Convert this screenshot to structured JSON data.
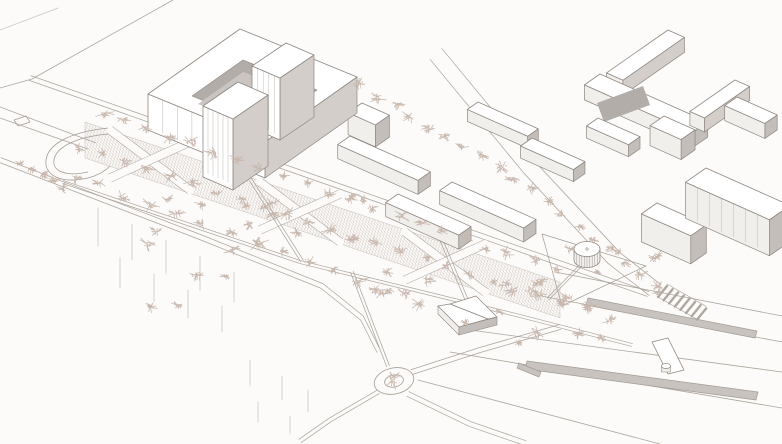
{
  "scene": {
    "width": 782,
    "height": 444,
    "background": "#fcfbf9",
    "colors": {
      "line": "#a49c94",
      "faint": "#c6c0ba",
      "bstroke": "#8f8780",
      "top": "#ffffff",
      "front": "#f1efec",
      "side": "#d3cec9",
      "sidedark": "#c3beb9",
      "court": "#b2ada8",
      "courtfloor": "#cac5c0",
      "tree": "#c8b7ad",
      "hatch": "#c2b4ab",
      "median": "#c8c3be",
      "stripe": "#aaa39c",
      "fline": "#b9b3ad"
    },
    "axes": {
      "a": [
        0.913,
        0.407
      ],
      "b": [
        -0.82,
        0.572
      ]
    }
  },
  "layers": [
    {
      "name": "street-topleft-cross",
      "type": "polyline",
      "pts": [
        [
          173,
          0
        ],
        [
          32,
          79
        ],
        [
          0,
          88
        ]
      ]
    },
    {
      "name": "street-topleft-corner",
      "type": "polyline",
      "pts": [
        [
          0,
          30
        ],
        [
          58,
          8
        ]
      ],
      "light": true
    },
    {
      "name": "street-left-a",
      "type": "polyline",
      "pts": [
        [
          0,
          107
        ],
        [
          96,
          143
        ]
      ]
    },
    {
      "name": "street-left-b",
      "type": "polyline",
      "pts": [
        [
          0,
          118
        ],
        [
          88,
          149
        ]
      ]
    },
    {
      "name": "car-left",
      "type": "polygon",
      "pts": [
        [
          14,
          120
        ],
        [
          26,
          116
        ],
        [
          30,
          122
        ],
        [
          18,
          126
        ]
      ],
      "fill": "none"
    },
    {
      "name": "road-park-north",
      "type": "double",
      "pts": [
        [
          30,
          78
        ],
        [
          350,
          190
        ],
        [
          648,
          294
        ]
      ],
      "gap": 5
    },
    {
      "name": "road-park-south",
      "type": "double",
      "pts": [
        [
          0,
          160
        ],
        [
          200,
          237
        ],
        [
          322,
          286
        ],
        [
          362,
          318
        ],
        [
          378,
          350
        ]
      ],
      "gap": 5
    },
    {
      "name": "road-diagonal-ne",
      "type": "double",
      "pts": [
        [
          436,
          54
        ],
        [
          530,
          168
        ],
        [
          614,
          258
        ],
        [
          655,
          290
        ]
      ],
      "gap": 16
    },
    {
      "name": "road-roundabout-ne",
      "type": "double",
      "pts": [
        [
          412,
          372
        ],
        [
          480,
          350
        ],
        [
          560,
          327
        ]
      ],
      "gap": 5
    },
    {
      "name": "road-roundabout-se",
      "type": "double",
      "pts": [
        [
          408,
          394
        ],
        [
          470,
          424
        ],
        [
          525,
          443
        ]
      ],
      "gap": 5
    },
    {
      "name": "road-roundabout-sw",
      "type": "double",
      "pts": [
        [
          378,
          392
        ],
        [
          330,
          420
        ],
        [
          300,
          441
        ]
      ],
      "gap": 4
    },
    {
      "name": "boulevard-edge-1",
      "type": "polyline",
      "pts": [
        [
          555,
          272
        ],
        [
          782,
          316
        ]
      ]
    },
    {
      "name": "boulevard-edge-2",
      "type": "polyline",
      "pts": [
        [
          536,
          295
        ],
        [
          782,
          342
        ]
      ]
    },
    {
      "name": "boulevard-edge-3",
      "type": "polyline",
      "pts": [
        [
          470,
          330
        ],
        [
          782,
          372
        ]
      ]
    },
    {
      "name": "boulevard-edge-4",
      "type": "polyline",
      "pts": [
        [
          450,
          352
        ],
        [
          782,
          408
        ]
      ]
    },
    {
      "name": "boulevard-edge-5",
      "type": "polyline",
      "pts": [
        [
          418,
          380
        ],
        [
          660,
          444
        ]
      ]
    },
    {
      "name": "plaza-hatch-band",
      "type": "hatchband",
      "pts": [
        [
          85,
          122
        ],
        [
          560,
          282
        ],
        [
          560,
          318
        ],
        [
          85,
          158
        ]
      ]
    },
    {
      "name": "park-path-x1a",
      "type": "whitestrip",
      "a": [
        110,
        130
      ],
      "b": [
        190,
        190
      ]
    },
    {
      "name": "park-path-x1b",
      "type": "whitestrip",
      "a": [
        190,
        142
      ],
      "b": [
        110,
        178
      ]
    },
    {
      "name": "park-path-x2a",
      "type": "whitestrip",
      "a": [
        260,
        182
      ],
      "b": [
        340,
        242
      ]
    },
    {
      "name": "park-path-x2b",
      "type": "whitestrip",
      "a": [
        340,
        194
      ],
      "b": [
        260,
        230
      ]
    },
    {
      "name": "park-path-x3a",
      "type": "whitestrip",
      "a": [
        405,
        232
      ],
      "b": [
        485,
        292
      ]
    },
    {
      "name": "park-path-x3b",
      "type": "whitestrip",
      "a": [
        485,
        244
      ],
      "b": [
        405,
        280
      ]
    },
    {
      "name": "median-strip-1",
      "type": "polygon",
      "pts": [
        [
          588,
          298
        ],
        [
          757,
          331
        ],
        [
          755,
          338
        ],
        [
          586,
          305
        ]
      ],
      "fill": "median",
      "stroke": true
    },
    {
      "name": "median-strip-2",
      "type": "polygon",
      "pts": [
        [
          527,
          361
        ],
        [
          758,
          392
        ],
        [
          756,
          400
        ],
        [
          525,
          369
        ]
      ],
      "fill": "median",
      "stroke": true
    },
    {
      "name": "median-strip-3",
      "type": "polygon",
      "pts": [
        [
          519,
          363
        ],
        [
          541,
          372
        ],
        [
          539,
          377
        ],
        [
          517,
          368
        ]
      ],
      "fill": "median",
      "stroke": true
    },
    {
      "name": "crosswalk",
      "type": "crosswalk",
      "start": [
        667,
        286
      ],
      "step": [
        5.6,
        3.2
      ],
      "n": 8,
      "vec": [
        -9,
        11
      ]
    },
    {
      "name": "pedestrian-bridge",
      "type": "bridge",
      "poly": [
        [
          652,
          342
        ],
        [
          668,
          338
        ],
        [
          684,
          370
        ],
        [
          668,
          374
        ]
      ],
      "cyl": [
        666,
        366
      ]
    },
    {
      "name": "park-path-mid",
      "type": "double",
      "pts": [
        [
          63,
          182
        ],
        [
          300,
          262
        ],
        [
          520,
          316
        ],
        [
          632,
          345
        ]
      ],
      "gap": 3
    },
    {
      "name": "park-path-d1",
      "type": "double",
      "pts": [
        [
          240,
          163
        ],
        [
          302,
          261
        ]
      ],
      "gap": 3
    },
    {
      "name": "park-path-d2",
      "type": "double",
      "pts": [
        [
          352,
          272
        ],
        [
          388,
          366
        ]
      ],
      "gap": 3
    },
    {
      "name": "park-path-d3",
      "type": "double",
      "pts": [
        [
          432,
          218
        ],
        [
          468,
          303
        ]
      ],
      "gap": 3
    },
    {
      "name": "park-loop-outer",
      "type": "pathd",
      "d": "M108,128 C70,132 48,144 46,160 C44,176 62,184 88,178 C100,175 106,170 110,166"
    },
    {
      "name": "park-loop-inner",
      "type": "pathd",
      "d": "M108,134 C76,137 56,147 54,160 C52,171 66,177 88,172"
    },
    {
      "name": "pavilion-plaza-outline",
      "type": "polygon",
      "pts": [
        [
          542,
          234
        ],
        [
          646,
          266
        ],
        [
          562,
          306
        ]
      ],
      "fill": "none"
    },
    {
      "name": "pavilion-path",
      "type": "double",
      "pts": [
        [
          584,
          262
        ],
        [
          548,
          299
        ]
      ],
      "gap": 2.5
    },
    {
      "name": "roundabout",
      "type": "roundabout",
      "cx": 394,
      "cy": 381,
      "rx": 20,
      "ry": 13,
      "irx": 9.5,
      "iry": 6,
      "rot": -12
    },
    {
      "name": "ground-ticks",
      "type": "ticks",
      "items": [
        [
          98,
          208,
          38
        ],
        [
          132,
          224,
          36
        ],
        [
          166,
          240,
          34
        ],
        [
          200,
          256,
          34
        ],
        [
          234,
          272,
          30
        ],
        [
          120,
          258,
          30
        ],
        [
          154,
          274,
          28
        ],
        [
          188,
          290,
          28
        ],
        [
          222,
          306,
          26
        ],
        [
          250,
          360,
          26
        ],
        [
          282,
          376,
          24
        ],
        [
          308,
          390,
          22
        ],
        [
          258,
          402,
          20
        ],
        [
          290,
          416,
          18
        ]
      ]
    },
    {
      "name": "bldg-cross-wing-a",
      "type": "bslab",
      "x": 668,
      "y": 30,
      "l": 75,
      "w": 18,
      "h": 15
    },
    {
      "name": "bldg-cross-bar",
      "type": "slab",
      "x": 600,
      "y": 74,
      "l": 118,
      "w": 19,
      "h": 15
    },
    {
      "name": "bldg-cross-wing-b",
      "type": "bslab",
      "x": 735,
      "y": 80,
      "l": 55,
      "w": 16,
      "h": 14
    },
    {
      "name": "bldg-cross-courtyard",
      "type": "polygon",
      "pts": [
        [
          597,
          103
        ],
        [
          643,
          86
        ],
        [
          650,
          105
        ],
        [
          604,
          122
        ]
      ],
      "fill": "court"
    },
    {
      "name": "bldg-bar-ne",
      "type": "slab",
      "x": 737,
      "y": 97,
      "l": 44,
      "w": 15,
      "h": 15
    },
    {
      "name": "bldg-bar-n1",
      "type": "slab",
      "x": 478,
      "y": 102,
      "l": 66,
      "w": 13,
      "h": 12
    },
    {
      "name": "bldg-bar-n2",
      "type": "slab",
      "x": 598,
      "y": 118,
      "l": 46,
      "w": 14,
      "h": 12
    },
    {
      "name": "bldg-bar-n3",
      "type": "slab",
      "x": 532,
      "y": 138,
      "l": 58,
      "w": 14,
      "h": 12
    },
    {
      "name": "bldg-cube-c1",
      "type": "slab",
      "x": 362,
      "y": 103,
      "l": 30,
      "w": 17,
      "h": 22
    },
    {
      "name": "bldg-courtyard-complex",
      "type": "courtyard",
      "outer": [
        [
          148,
          94
        ],
        [
          240,
          29
        ],
        [
          357,
          77
        ],
        [
          265,
          142
        ]
      ],
      "hole": [
        [
          192,
          96
        ],
        [
          243,
          60
        ],
        [
          317,
          90
        ],
        [
          266,
          126
        ]
      ],
      "floor": [
        [
          198,
          104
        ],
        [
          243,
          72
        ],
        [
          308,
          96
        ],
        [
          263,
          128
        ]
      ],
      "h": 36,
      "flines": 7
    },
    {
      "name": "bldg-tower-2",
      "type": "tower",
      "top": [
        [
          252,
          66
        ],
        [
          286,
          43
        ],
        [
          314,
          55
        ],
        [
          280,
          78
        ]
      ],
      "h": 62,
      "flines": 4
    },
    {
      "name": "bldg-tower-1",
      "type": "tower",
      "top": [
        [
          203,
          106
        ],
        [
          238,
          82
        ],
        [
          268,
          95
        ],
        [
          233,
          119
        ]
      ],
      "h": 71,
      "flines": 5
    },
    {
      "name": "bldg-slab-m1",
      "type": "slab",
      "x": 350,
      "y": 136,
      "l": 88,
      "w": 15,
      "h": 14
    },
    {
      "name": "bldg-slab-m2",
      "type": "slab",
      "x": 398,
      "y": 194,
      "l": 80,
      "w": 15,
      "h": 14
    },
    {
      "name": "bldg-slab-m3",
      "type": "slab",
      "x": 452,
      "y": 182,
      "l": 92,
      "w": 15,
      "h": 14
    },
    {
      "name": "bldg-cube-c2",
      "type": "slab",
      "x": 664,
      "y": 116,
      "l": 34,
      "w": 17,
      "h": 20
    },
    {
      "name": "bldg-block-se2",
      "type": "slab",
      "x": 657,
      "y": 203,
      "l": 54,
      "w": 19,
      "h": 28
    },
    {
      "name": "bldg-block-se1",
      "type": "slab",
      "x": 706,
      "y": 168,
      "l": 92,
      "w": 25,
      "h": 36,
      "flines": 6
    },
    {
      "name": "bldg-park-gable",
      "type": "gable",
      "eaves": [
        [
          438,
          306
        ],
        [
          476,
          296
        ],
        [
          497,
          317
        ],
        [
          459,
          327
        ]
      ],
      "ridge": [
        [
          450,
          304
        ],
        [
          488,
          319
        ]
      ],
      "h": 8
    },
    {
      "name": "pavilion",
      "type": "pavilion",
      "cx": 587,
      "cy": 249,
      "rx": 13,
      "ry": 7.5,
      "h": 11
    },
    {
      "name": "trees-row-north",
      "type": "trees-row",
      "pts": [
        [
          90,
          108
        ],
        [
          545,
          266
        ]
      ],
      "count": 20,
      "size": 6
    },
    {
      "name": "trees-row-mid",
      "type": "trees-row",
      "pts": [
        [
          66,
          143
        ],
        [
          620,
          322
        ]
      ],
      "count": 24,
      "size": 6
    },
    {
      "name": "trees-row-south",
      "type": "trees-row",
      "pts": [
        [
          60,
          170
        ],
        [
          400,
          296
        ]
      ],
      "count": 13,
      "size": 6
    },
    {
      "name": "trees-row-street",
      "type": "trees-row",
      "pts": [
        [
          352,
          80
        ],
        [
          520,
          182
        ],
        [
          665,
          294
        ]
      ],
      "count": 19,
      "size": 6
    },
    {
      "name": "trees-row-lefttip",
      "type": "trees-row",
      "pts": [
        [
          15,
          158
        ],
        [
          70,
          190
        ]
      ],
      "count": 5,
      "size": 5
    },
    {
      "name": "trees-scatter-core",
      "type": "trees-scatter",
      "x": 140,
      "y": 195,
      "w": 290,
      "h": 115,
      "count": 24,
      "size": 6
    },
    {
      "name": "trees-scatter-se",
      "type": "trees-scatter",
      "x": 430,
      "y": 280,
      "w": 190,
      "h": 70,
      "count": 12,
      "size": 6
    },
    {
      "name": "trees-scatter-plaza",
      "type": "trees-scatter",
      "x": 540,
      "y": 232,
      "w": 120,
      "h": 66,
      "count": 8,
      "size": 5
    },
    {
      "name": "tree-roundabout",
      "type": "tree",
      "x": 394,
      "y": 379,
      "size": 10
    }
  ]
}
